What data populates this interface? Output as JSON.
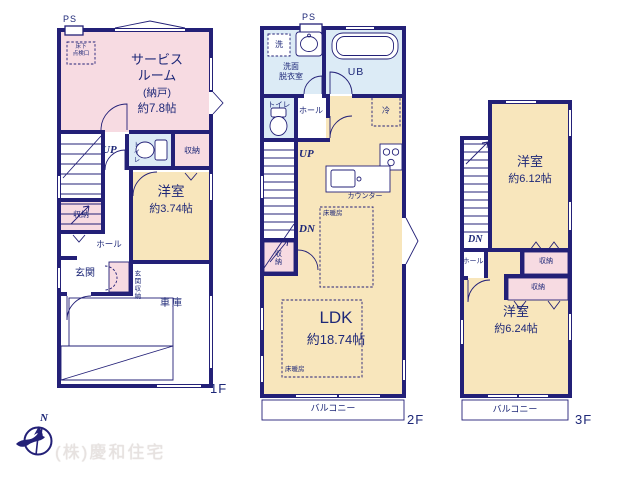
{
  "colors": {
    "wall": "#232077",
    "room_pink": "#f7dbe2",
    "room_tan": "#f8e6bc",
    "room_blue": "#dcebf6",
    "text": "#1e2878",
    "watermark": "#e7e2e0"
  },
  "floor1": {
    "ps_label": "PS",
    "inspection_line1": "床下",
    "inspection_line2": "点検口",
    "service_room_name_line1": "サービス",
    "service_room_name_line2": "ルーム",
    "service_room_type": "(納戸)",
    "service_room_size": "約7.8帖",
    "up_label": "UP",
    "toilet_label": "トイレ",
    "closet_right_label": "収納",
    "bedroom_name": "洋室",
    "bedroom_size": "約3.74帖",
    "closet_left_label": "収納",
    "hall_label": "ホール",
    "entrance_label": "玄関",
    "entrance_closet_label": "玄関収納",
    "garage_label": "車庫",
    "floor_label": "1F"
  },
  "floor2": {
    "ps_label": "PS",
    "washer_label": "洗",
    "washroom_line1": "洗面",
    "washroom_line2": "脱衣室",
    "bath_label": "UB",
    "toilet_label": "トイレ",
    "hall_label": "ホール",
    "fridge_label": "冷",
    "up_label": "UP",
    "dn_label": "DN",
    "closet_label": "収納",
    "counter_label": "カウンター",
    "heating1_label": "床暖房",
    "heating2_label": "床暖房",
    "ldk_name": "LDK",
    "ldk_size": "約18.74帖",
    "balcony_label": "バルコニー",
    "floor_label": "2F"
  },
  "floor3": {
    "bedroom_top_name": "洋室",
    "bedroom_top_size": "約6.12帖",
    "dn_label": "DN",
    "hall_label": "ホール",
    "closet_top_label": "収納",
    "closet_bottom_label": "収納",
    "bedroom_bottom_name": "洋室",
    "bedroom_bottom_size": "約6.24帖",
    "balcony_label": "バルコニー",
    "floor_label": "3F"
  },
  "footer": {
    "company_name": "(株)慶和住宅",
    "compass_north_label": "N"
  }
}
